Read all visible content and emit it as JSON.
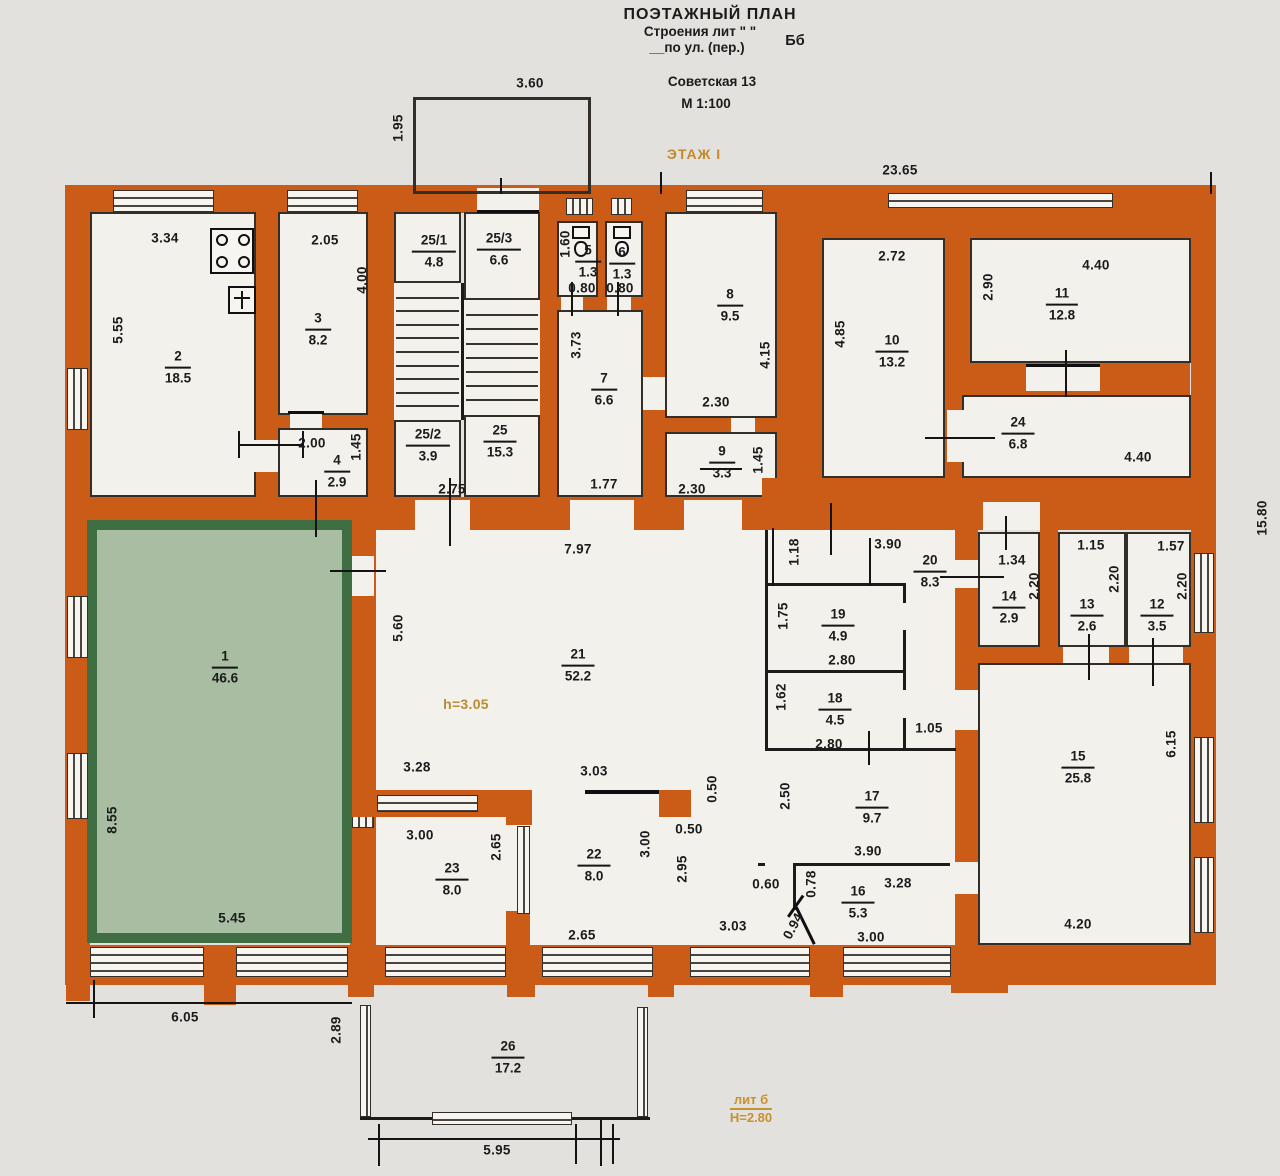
{
  "title": {
    "line1": "ПОЭТАЖНЫЙ ПЛАН",
    "line2": "Строения лит \" \"",
    "line3": "__по ул. (пер.)",
    "lit": "Бб",
    "address": "Советская 13",
    "scale": "М 1:100",
    "floor": "ЭТАЖ I"
  },
  "notes": {
    "hall_height": "h=3.05",
    "annex_lit": "лит б",
    "annex_height": "Н=2.80"
  },
  "rooms": [
    {
      "num": "1",
      "area": "46.6",
      "x": 225,
      "y": 668
    },
    {
      "num": "2",
      "area": "18.5",
      "x": 178,
      "y": 368
    },
    {
      "num": "3",
      "area": "8.2",
      "x": 318,
      "y": 330
    },
    {
      "num": "4",
      "area": "2.9",
      "x": 337,
      "y": 472
    },
    {
      "num": "25/1",
      "area": "4.8",
      "x": 434,
      "y": 252
    },
    {
      "num": "25/3",
      "area": "6.6",
      "x": 499,
      "y": 250
    },
    {
      "num": "25/2",
      "area": "3.9",
      "x": 428,
      "y": 446
    },
    {
      "num": "25",
      "area": "15.3",
      "x": 500,
      "y": 442
    },
    {
      "num": "5",
      "area": "1.3",
      "x": 588,
      "y": 262
    },
    {
      "num": "6",
      "area": "1.3",
      "x": 622,
      "y": 264
    },
    {
      "num": "7",
      "area": "6.6",
      "x": 604,
      "y": 390
    },
    {
      "num": "8",
      "area": "9.5",
      "x": 730,
      "y": 306
    },
    {
      "num": "9",
      "area": "3.3",
      "x": 722,
      "y": 463
    },
    {
      "num": "10",
      "area": "13.2",
      "x": 892,
      "y": 352
    },
    {
      "num": "11",
      "area": "12.8",
      "x": 1062,
      "y": 305
    },
    {
      "num": "24",
      "area": "6.8",
      "x": 1018,
      "y": 434
    },
    {
      "num": "21",
      "area": "52.2",
      "x": 578,
      "y": 666
    },
    {
      "num": "20",
      "area": "8.3",
      "x": 930,
      "y": 572
    },
    {
      "num": "19",
      "area": "4.9",
      "x": 838,
      "y": 626
    },
    {
      "num": "18",
      "area": "4.5",
      "x": 835,
      "y": 710
    },
    {
      "num": "17",
      "area": "9.7",
      "x": 872,
      "y": 808
    },
    {
      "num": "14",
      "area": "2.9",
      "x": 1009,
      "y": 608
    },
    {
      "num": "13",
      "area": "2.6",
      "x": 1087,
      "y": 616
    },
    {
      "num": "12",
      "area": "3.5",
      "x": 1157,
      "y": 616
    },
    {
      "num": "15",
      "area": "25.8",
      "x": 1078,
      "y": 768
    },
    {
      "num": "16",
      "area": "5.3",
      "x": 858,
      "y": 903
    },
    {
      "num": "22",
      "area": "8.0",
      "x": 594,
      "y": 866
    },
    {
      "num": "23",
      "area": "8.0",
      "x": 452,
      "y": 880
    },
    {
      "num": "26",
      "area": "17.2",
      "x": 508,
      "y": 1058
    }
  ],
  "dims": [
    {
      "t": "3.60",
      "x": 530,
      "y": 83
    },
    {
      "t": "1.95",
      "x": 398,
      "y": 128,
      "r": 1
    },
    {
      "t": "23.65",
      "x": 900,
      "y": 170
    },
    {
      "t": "3.34",
      "x": 165,
      "y": 238
    },
    {
      "t": "2.05",
      "x": 325,
      "y": 240
    },
    {
      "t": "5.55",
      "x": 118,
      "y": 330,
      "r": 1
    },
    {
      "t": "4.00",
      "x": 362,
      "y": 280,
      "r": 1
    },
    {
      "t": "2.00",
      "x": 312,
      "y": 443
    },
    {
      "t": "1.45",
      "x": 356,
      "y": 447,
      "r": 1
    },
    {
      "t": "2.75",
      "x": 452,
      "y": 489
    },
    {
      "t": "1.60",
      "x": 565,
      "y": 244,
      "r": 1
    },
    {
      "t": "0.80",
      "x": 582,
      "y": 288
    },
    {
      "t": "0.80",
      "x": 620,
      "y": 288
    },
    {
      "t": "3.73",
      "x": 576,
      "y": 345,
      "r": 1
    },
    {
      "t": "1.77",
      "x": 604,
      "y": 484
    },
    {
      "t": "4.15",
      "x": 765,
      "y": 355,
      "r": 1
    },
    {
      "t": "2.30",
      "x": 716,
      "y": 402
    },
    {
      "t": "2.30",
      "x": 692,
      "y": 489
    },
    {
      "t": "1.45",
      "x": 758,
      "y": 460,
      "r": 1
    },
    {
      "t": "2.72",
      "x": 892,
      "y": 256
    },
    {
      "t": "4.85",
      "x": 840,
      "y": 334,
      "r": 1
    },
    {
      "t": "4.40",
      "x": 1096,
      "y": 265
    },
    {
      "t": "2.90",
      "x": 988,
      "y": 287,
      "r": 1
    },
    {
      "t": "4.40",
      "x": 1138,
      "y": 457
    },
    {
      "t": "15.80",
      "x": 1262,
      "y": 518,
      "r": 1
    },
    {
      "t": "7.97",
      "x": 578,
      "y": 549
    },
    {
      "t": "5.60",
      "x": 398,
      "y": 628,
      "r": 1
    },
    {
      "t": "8.55",
      "x": 112,
      "y": 820,
      "r": 1
    },
    {
      "t": "5.45",
      "x": 232,
      "y": 918
    },
    {
      "t": "1.18",
      "x": 794,
      "y": 552,
      "r": 1
    },
    {
      "t": "3.90",
      "x": 888,
      "y": 544
    },
    {
      "t": "1.75",
      "x": 783,
      "y": 616,
      "r": 1
    },
    {
      "t": "2.80",
      "x": 842,
      "y": 660
    },
    {
      "t": "1.62",
      "x": 781,
      "y": 697,
      "r": 1
    },
    {
      "t": "2.80",
      "x": 829,
      "y": 744
    },
    {
      "t": "1.34",
      "x": 1012,
      "y": 560
    },
    {
      "t": "2.20",
      "x": 1034,
      "y": 586,
      "r": 1
    },
    {
      "t": "1.15",
      "x": 1091,
      "y": 545
    },
    {
      "t": "2.20",
      "x": 1114,
      "y": 579,
      "r": 1
    },
    {
      "t": "1.57",
      "x": 1171,
      "y": 546
    },
    {
      "t": "2.20",
      "x": 1182,
      "y": 586,
      "r": 1
    },
    {
      "t": "1.05",
      "x": 929,
      "y": 728
    },
    {
      "t": "6.15",
      "x": 1171,
      "y": 744,
      "r": 1
    },
    {
      "t": "2.50",
      "x": 785,
      "y": 796,
      "r": 1
    },
    {
      "t": "3.90",
      "x": 868,
      "y": 851
    },
    {
      "t": "0.50",
      "x": 712,
      "y": 789,
      "r": 1
    },
    {
      "t": "0.50",
      "x": 689,
      "y": 829
    },
    {
      "t": "3.28",
      "x": 417,
      "y": 767
    },
    {
      "t": "3.03",
      "x": 594,
      "y": 771
    },
    {
      "t": "3.00",
      "x": 420,
      "y": 835
    },
    {
      "t": "2.65",
      "x": 496,
      "y": 847,
      "r": 1
    },
    {
      "t": "3.00",
      "x": 645,
      "y": 844,
      "r": 1
    },
    {
      "t": "2.95",
      "x": 682,
      "y": 869,
      "r": 1
    },
    {
      "t": "0.60",
      "x": 766,
      "y": 884
    },
    {
      "t": "0.78",
      "x": 811,
      "y": 884,
      "r": 1
    },
    {
      "t": "3.28",
      "x": 898,
      "y": 883
    },
    {
      "t": "3.00",
      "x": 871,
      "y": 937
    },
    {
      "t": "0.94",
      "x": 793,
      "y": 926,
      "r": 2
    },
    {
      "t": "3.03",
      "x": 733,
      "y": 926
    },
    {
      "t": "2.65",
      "x": 582,
      "y": 935
    },
    {
      "t": "4.20",
      "x": 1078,
      "y": 924
    },
    {
      "t": "6.05",
      "x": 185,
      "y": 1017
    },
    {
      "t": "2.89",
      "x": 336,
      "y": 1030,
      "r": 1
    },
    {
      "t": "5.95",
      "x": 497,
      "y": 1150
    }
  ]
}
